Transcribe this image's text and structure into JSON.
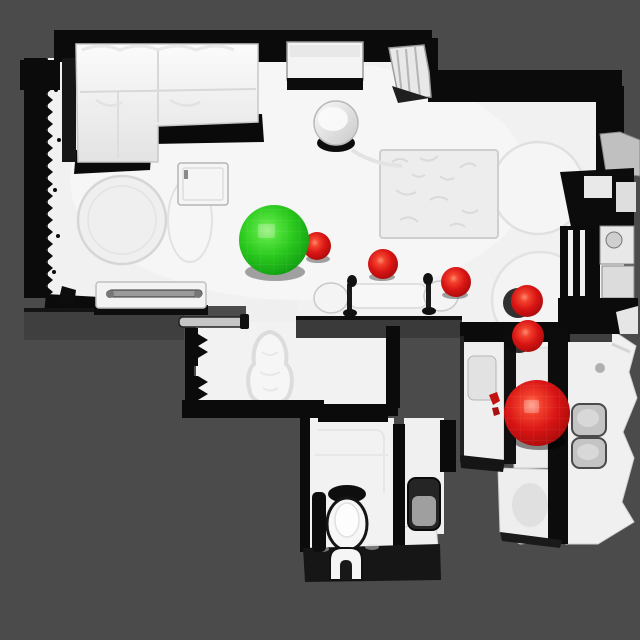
{
  "scene": {
    "background_color": "#4b4b4b",
    "floor_color": "#f1f1f1",
    "wall_color": "#0b0b0b",
    "marker_green_color": "#2bc91e",
    "marker_red_color": "#d81414"
  },
  "spheres": {
    "green": {
      "id": "green-sphere",
      "x": 274,
      "y": 240,
      "r": 35,
      "color": "#2bc91e"
    },
    "red": [
      {
        "id": "red-sphere-1",
        "x": 317,
        "y": 246,
        "r": 14,
        "color": "#d81414"
      },
      {
        "id": "red-sphere-2",
        "x": 383,
        "y": 264,
        "r": 15,
        "color": "#d81414"
      },
      {
        "id": "red-sphere-3",
        "x": 456,
        "y": 282,
        "r": 15,
        "color": "#d81414"
      },
      {
        "id": "red-sphere-4",
        "x": 527,
        "y": 301,
        "r": 16,
        "color": "#d81414"
      },
      {
        "id": "red-sphere-5",
        "x": 528,
        "y": 336,
        "r": 16,
        "color": "#d81414"
      },
      {
        "id": "red-sphere-6",
        "x": 537,
        "y": 413,
        "r": 33,
        "color": "#d81414"
      }
    ],
    "green_count": 1,
    "red_count": 6
  }
}
